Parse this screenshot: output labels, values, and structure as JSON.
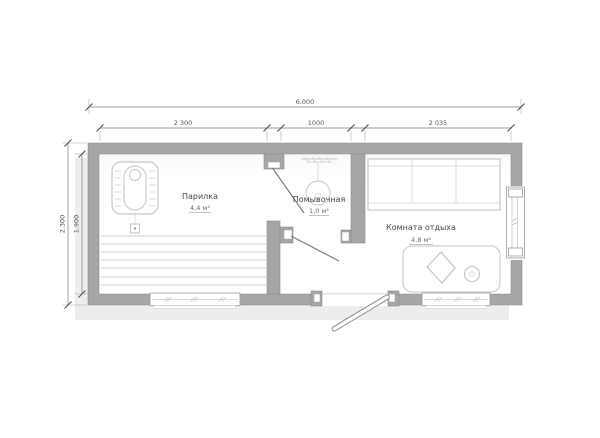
{
  "rooms": [
    {
      "name": "Парилка",
      "area": "4,4 м²"
    },
    {
      "name": "Помывочная",
      "area": "1,0 м²"
    },
    {
      "name": "Комната отдыха",
      "area": "4,8 м²"
    }
  ],
  "dimensions": {
    "overall_width": "6.000",
    "width_segments": [
      "2 300",
      "1000",
      "2 035"
    ],
    "overall_depth": "2.300",
    "inner_depth": "1.900"
  },
  "icons": [
    {
      "name": "stove-icon",
      "room": "Парилка"
    },
    {
      "name": "bench-tiers-icon",
      "room": "Парилка"
    },
    {
      "name": "shower-icon",
      "room": "Помывочная"
    },
    {
      "name": "bed-icon",
      "room": "Комната отдыха"
    },
    {
      "name": "table-icon",
      "room": "Комната отдыха"
    },
    {
      "name": "stool-icon",
      "room": "Комната отдыха"
    },
    {
      "name": "window-icon",
      "count": 3
    },
    {
      "name": "door-icon",
      "count": 3
    }
  ],
  "colors": {
    "wall": "#a6a6a6",
    "shadow": "#ededed",
    "floor": "#ffffff",
    "furniture_stroke": "#c6c6c6",
    "dimension_text": "#555555"
  }
}
